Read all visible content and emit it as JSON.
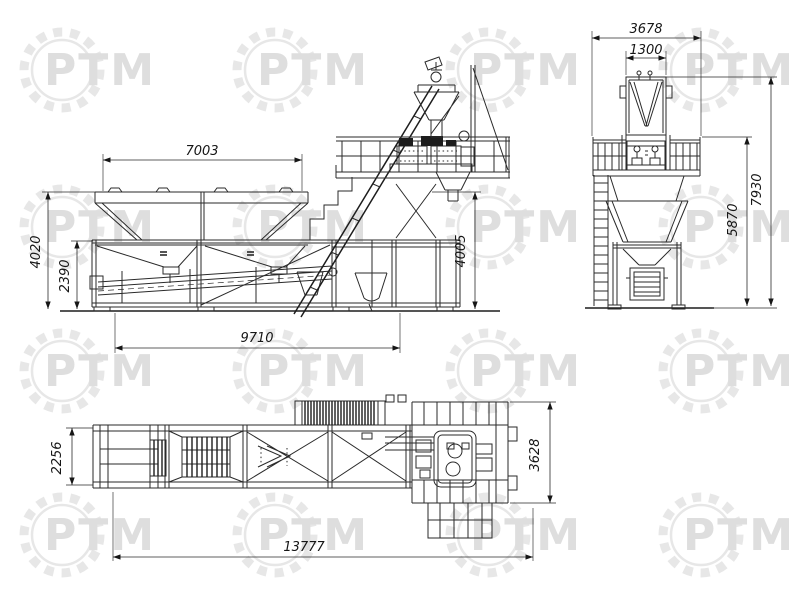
{
  "watermark": {
    "text": "РТМ"
  },
  "dimensions_mm": {
    "side_view": {
      "bins_top_width": "7003",
      "overall_height": "4020",
      "frame_height": "2390",
      "base_length": "9710",
      "discharge_clearance": "4005"
    },
    "end_view": {
      "overall_width": "3678",
      "skip_hopper_width": "1300",
      "overall_height": "7930",
      "platform_height": "5870"
    },
    "plan_view": {
      "chassis_width": "2256",
      "mixer_platform_width": "3628",
      "overall_length": "13777"
    }
  },
  "colors": {
    "line": "#2a2a2a",
    "background": "#ffffff",
    "watermark_gear": "#e7e7e7",
    "watermark_text": "#dedede"
  }
}
